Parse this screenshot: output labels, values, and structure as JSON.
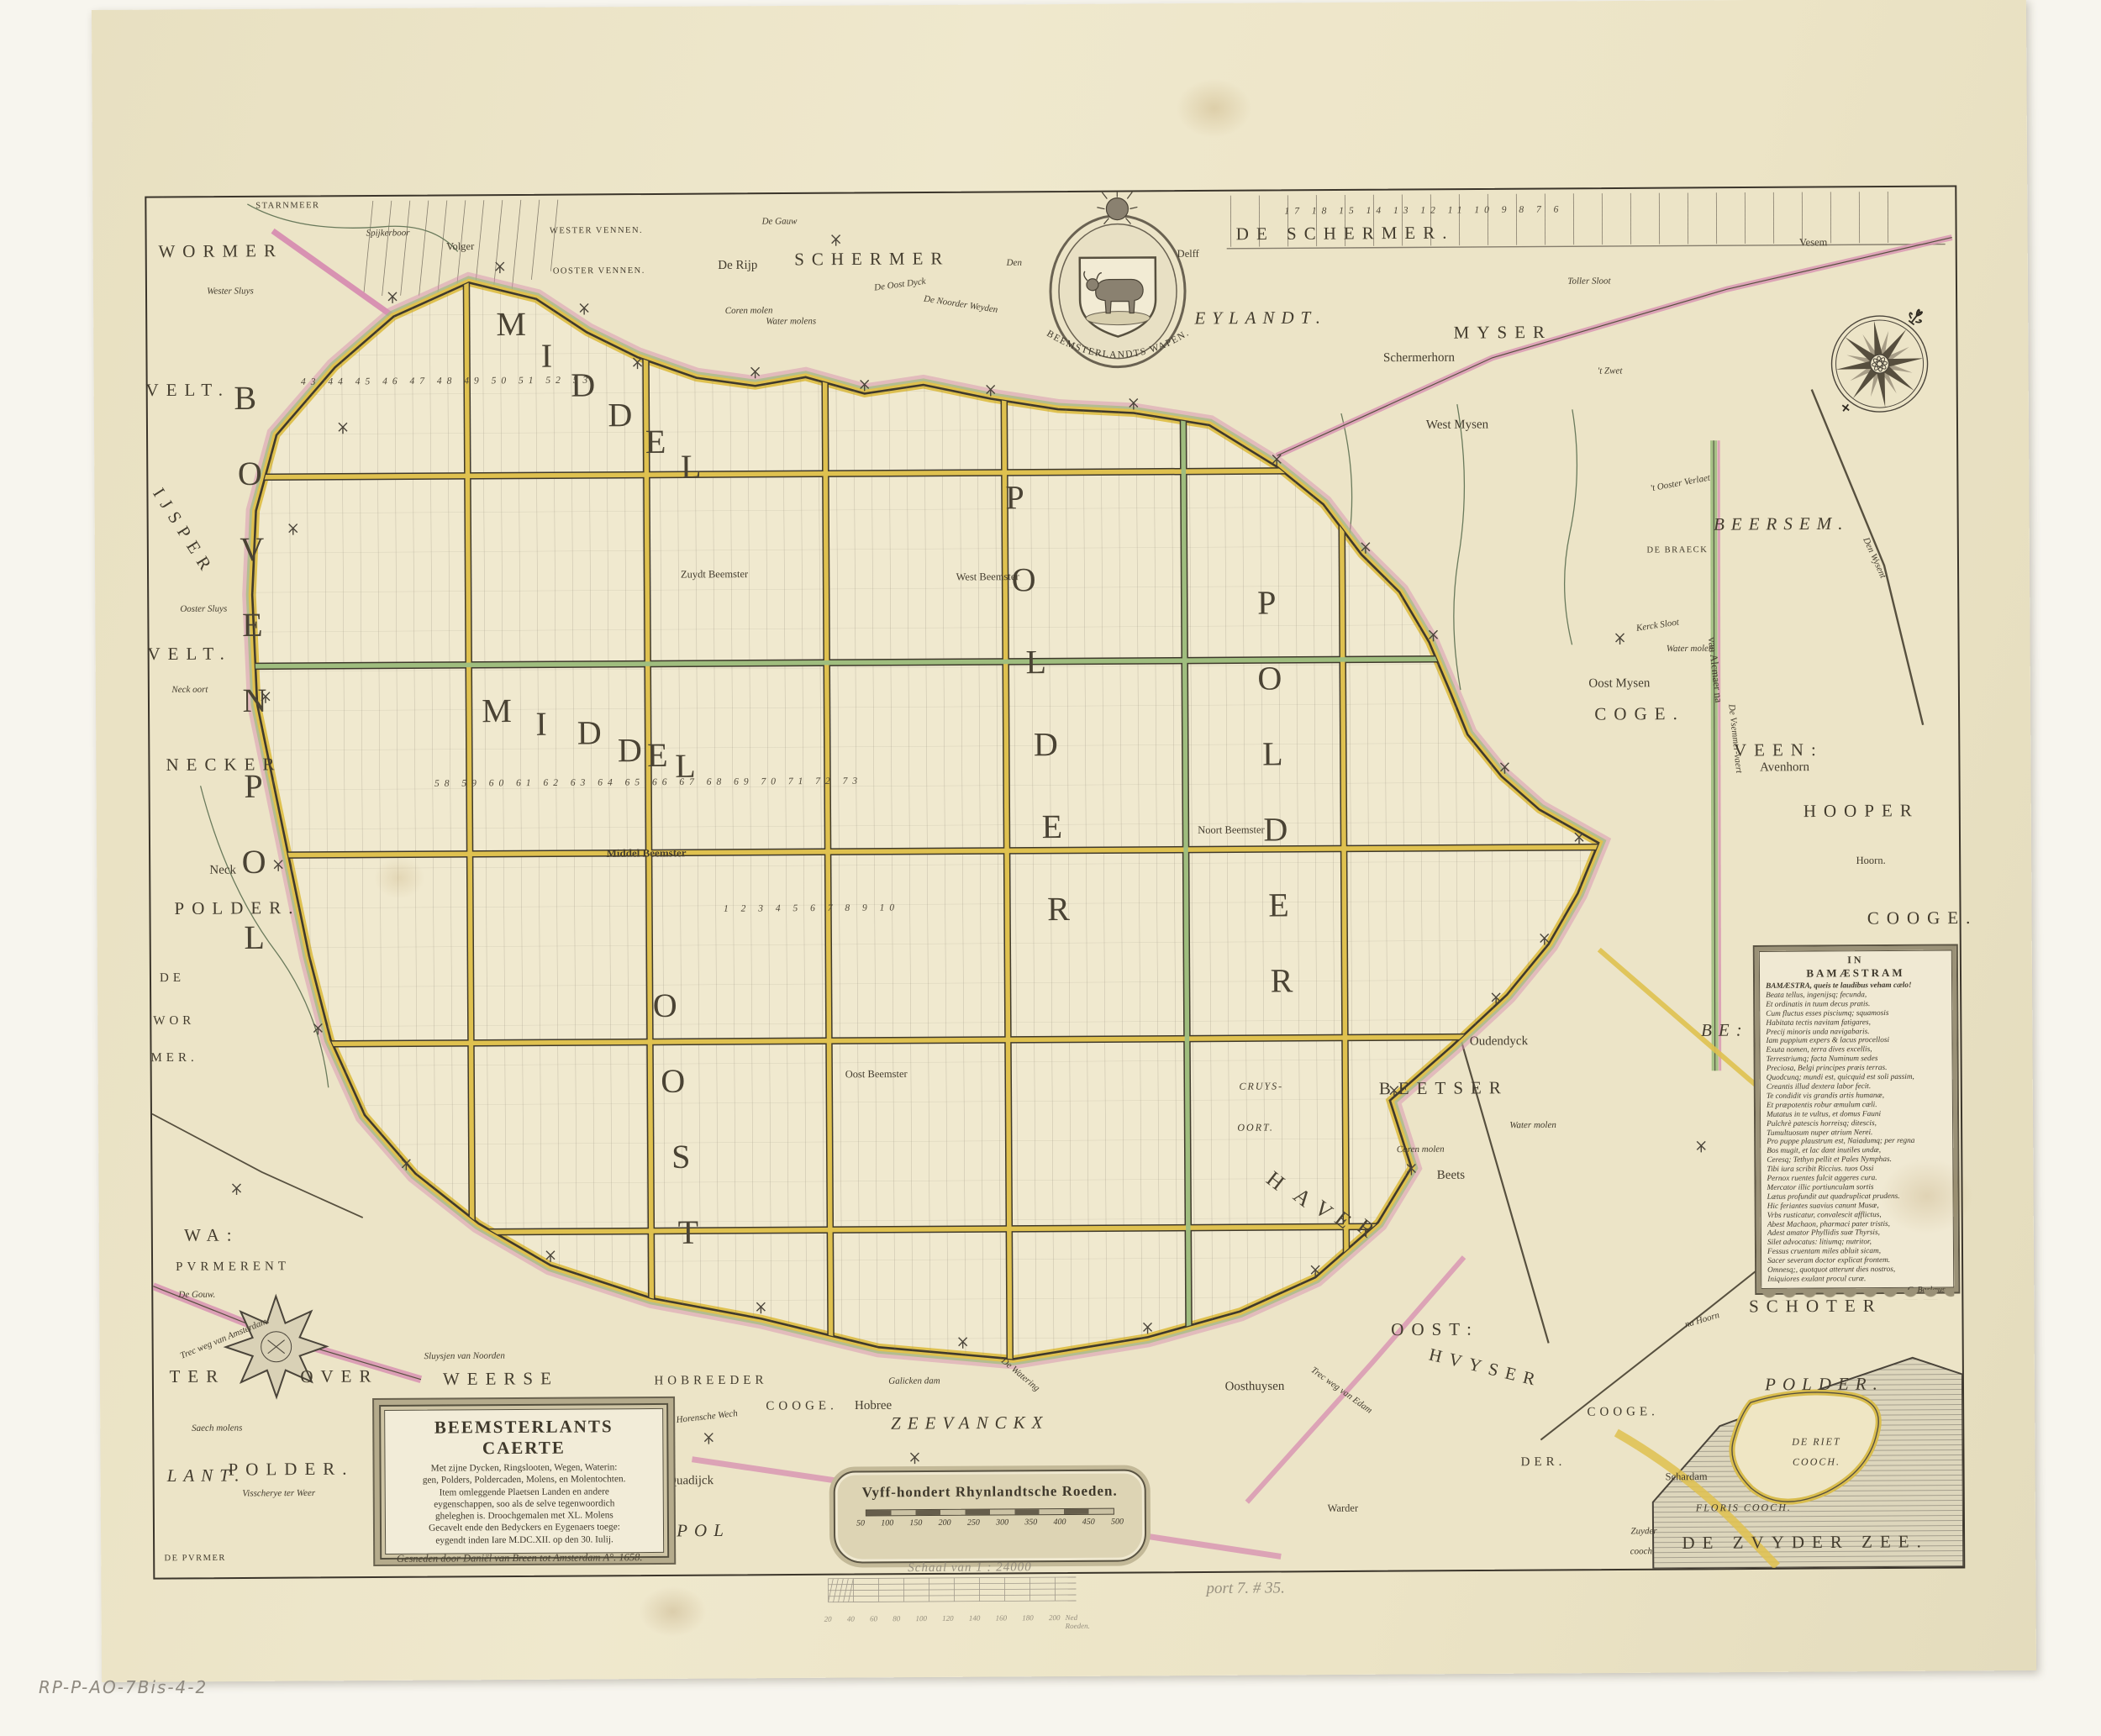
{
  "title_cartouche": {
    "title": "BEEMSTERLANTS CAERTE",
    "body_lines": [
      "Met zijne Dycken, Ringslooten, Wegen, Waterin:",
      "gen, Polders, Poldercaden, Molens, en Molentochten.",
      "Item omleggende Plaetsen Landen en andere",
      "eygenschappen, soo als de selve tegenwoordich",
      "gheleghen is. Droochgemalen met XL. Molens",
      "Gecavelt ende den Bedyckers en Eygenaers toege:",
      "eygendt inden Iare M.DC.XII. op den 30. Iulij."
    ],
    "imprint": "Gesneden door Daniël van Breen tot Amsterdam A°. 1658."
  },
  "scale_cartouche": {
    "title": "Vyff-hondert Rhynlandtsche Roeden.",
    "ticks": [
      "50",
      "100",
      "150",
      "200",
      "250",
      "300",
      "350",
      "400",
      "450",
      "500"
    ]
  },
  "poem": {
    "header1": "IN",
    "header2": "BAMÆSTRAM",
    "lines": [
      "BAMÆSTRA, queis te laudibus veham cælo!",
      "Beata tellus, ingenijsq; fecunda,",
      "Et ordinatis in tuum decus pratis.",
      "Cum fluctus esses pisciumq; squamosis",
      "Habitata tectis navitam fatigares,",
      "Precij minoris unda navigabaris.",
      "Iam puppium expers & lacus procellosi",
      "Exuta nomen, terra dives excellis,",
      "Terrestriumq; facta Numinum sedes",
      "Preciosa, Belgi principes præis terras.",
      "Quodcunq; mundi est, quicquid est soli passim,",
      "Creantis illud dextera labor fecit.",
      "Te condidit vis grandis artis humanæ,",
      "Et præpotentis robur æmulum cæli.",
      "Mutatus in te vultus, et domus Fauni",
      "Pulchrè patescis horreisq; ditescis,",
      "Tumultuosum nuper atrium Nerei.",
      "Pro puppe plaustrum est, Naiadumq; per regna",
      "Bos mugit, et lac dant inutiles undæ,",
      "Ceresq; Tethyn pellit et Pales Nymphas.",
      "Tibi iura scribit Riccius. tuos Ossi",
      "Pernox ruentes fulcit aggeres cura.",
      "Mercator illic portiunculam sortis",
      "Lætus profundit aut quadruplicat prudens.",
      "Hic feriantes suavius canunt Musæ,",
      "Vrbs rusticatur, convalescit afflictus,",
      "Abest Machaon, pharmaci pater tristis,",
      "Adest amator Phyllidis suæ Thyrsis,",
      "Silet advocatus: litiumq; nutritor,",
      "Fessus cruentam miles abluit sicam,",
      "Sacer severam doctor explicat frontem.",
      "Omnesq;, quotquot atterunt dies nostros,",
      "Iniquiores exulant procul curæ."
    ],
    "signature": "C. Barlæus."
  },
  "arms": {
    "caption": "BEEMSTERLANDTS WAPEN."
  },
  "pencil": {
    "scale_note": "Schaal van 1 : 24000",
    "ticks": [
      "20",
      "40",
      "60",
      "80",
      "100",
      "120",
      "140",
      "160",
      "180",
      "200"
    ],
    "unit": "Ned Roeden.",
    "inventory_note": "port 7. # 35.",
    "collection_mark": "RP-P-AO-7Bis-4-2"
  },
  "colors": {
    "paper": "#ece4c7",
    "road_yellow": "#dfc14f",
    "dike_pink": "#d892b2",
    "canal_green": "#9fbd7e",
    "ink": "#3f392c",
    "pencil": "#97907f"
  },
  "map_labels": [
    [
      "B",
      116,
      239,
      "g"
    ],
    [
      "O",
      121,
      329,
      "g"
    ],
    [
      "V",
      123,
      419,
      "g"
    ],
    [
      "E",
      123,
      509,
      "g"
    ],
    [
      "N",
      125,
      599,
      "g"
    ],
    [
      "P",
      123,
      701,
      "g"
    ],
    [
      "O",
      123,
      791,
      "g"
    ],
    [
      "L",
      123,
      881,
      "g"
    ],
    [
      "M",
      433,
      153,
      "g"
    ],
    [
      "I",
      475,
      191,
      "g"
    ],
    [
      "D",
      518,
      226,
      "g"
    ],
    [
      "D",
      562,
      262,
      "g"
    ],
    [
      "E",
      604,
      294,
      "g"
    ],
    [
      "L",
      646,
      324,
      "g"
    ],
    [
      "M",
      413,
      613,
      "g"
    ],
    [
      "I",
      466,
      629,
      "g"
    ],
    [
      "D",
      523,
      640,
      "g"
    ],
    [
      "D",
      571,
      661,
      "g"
    ],
    [
      "E",
      604,
      667,
      "g"
    ],
    [
      "L",
      637,
      680,
      "g"
    ],
    [
      "P",
      1031,
      363,
      "g"
    ],
    [
      "O",
      1041,
      461,
      "g"
    ],
    [
      "L",
      1055,
      559,
      "g"
    ],
    [
      "D",
      1066,
      657,
      "g"
    ],
    [
      "E",
      1073,
      755,
      "g"
    ],
    [
      "R",
      1080,
      853,
      "g"
    ],
    [
      "P",
      1330,
      490,
      "g"
    ],
    [
      "O",
      1333,
      580,
      "g"
    ],
    [
      "L",
      1336,
      670,
      "g"
    ],
    [
      "D",
      1339,
      760,
      "g"
    ],
    [
      "E",
      1342,
      850,
      "g"
    ],
    [
      "R",
      1345,
      940,
      "g"
    ],
    [
      "O",
      611,
      965,
      "g"
    ],
    [
      "O",
      620,
      1055,
      "g"
    ],
    [
      "S",
      629,
      1145,
      "g"
    ],
    [
      "T",
      637,
      1235,
      "g"
    ],
    [
      "H",
      1336,
      1178,
      "g2",
      38
    ],
    [
      "A",
      1368,
      1198,
      "g2",
      38
    ],
    [
      "V",
      1393,
      1213,
      "g2",
      38
    ],
    [
      "E",
      1416,
      1225,
      "g2",
      38
    ],
    [
      "R",
      1443,
      1235,
      "g2",
      38
    ],
    [
      "WORMER",
      88,
      64,
      "b"
    ],
    [
      "SCHERMER",
      863,
      78,
      "b"
    ],
    [
      "DE SCHERMER.",
      1426,
      51,
      "b"
    ],
    [
      "EYLANDT.",
      1325,
      151,
      "bi"
    ],
    [
      "MYSER",
      1613,
      170,
      "b"
    ],
    [
      "BEERSEM.",
      1943,
      400,
      "bi"
    ],
    [
      "COGE.",
      1773,
      625,
      "b"
    ],
    [
      "VEEN:",
      1938,
      669,
      "b"
    ],
    [
      "HOOPER",
      2036,
      742,
      "b"
    ],
    [
      "COOGE.",
      2108,
      870,
      "b"
    ],
    [
      "BEETSER",
      1537,
      1069,
      "b"
    ],
    [
      "BE:",
      1872,
      1002,
      "bi"
    ],
    [
      "SCHOTER",
      1978,
      1331,
      "b"
    ],
    [
      "POLDER.",
      1988,
      1424,
      "bi"
    ],
    [
      "DE ZVYDER ZEE.",
      1964,
      1612,
      "b"
    ],
    [
      "ZEEVANCKX",
      971,
      1464,
      "bi"
    ],
    [
      "OVER",
      221,
      1404,
      "b"
    ],
    [
      "WEERSE",
      413,
      1408,
      "b"
    ],
    [
      "OOST:",
      1525,
      1356,
      "b"
    ],
    [
      "HVYSER",
      1585,
      1402,
      "b",
      14
    ],
    [
      "COOGE.",
      1748,
      1456,
      "ms"
    ],
    [
      "DER.",
      1653,
      1515,
      "ms"
    ],
    [
      "HOBREEDER",
      663,
      1412,
      "ms"
    ],
    [
      "COOGE.",
      771,
      1443,
      "ms"
    ],
    [
      "POL",
      653,
      1590,
      "bi"
    ],
    [
      "WA:",
      70,
      1235,
      "b"
    ],
    [
      "TER",
      52,
      1403,
      "b"
    ],
    [
      "LANT.",
      62,
      1521,
      "bi"
    ],
    [
      "POLDER.",
      163,
      1514,
      "b"
    ],
    [
      "VELT.",
      48,
      229,
      "b"
    ],
    [
      "VELT.",
      48,
      543,
      "b"
    ],
    [
      "NECKER",
      88,
      675,
      "b"
    ],
    [
      "POLDER.",
      103,
      846,
      "b"
    ],
    [
      "IJSPER",
      42,
      398,
      "b",
      58
    ],
    [
      "DE",
      25,
      929,
      "ms"
    ],
    [
      "WOR",
      27,
      980,
      "ms"
    ],
    [
      "MER.",
      27,
      1024,
      "ms"
    ],
    [
      "STARNMEER",
      168,
      11,
      "tc"
    ],
    [
      "Spijkerboor",
      287,
      44,
      "t"
    ],
    [
      "Volger",
      373,
      60,
      "s"
    ],
    [
      "De Rijp",
      703,
      85,
      "m"
    ],
    [
      "De Gauw",
      753,
      33,
      "t"
    ],
    [
      "WESTER VENNEN.",
      535,
      43,
      "tc"
    ],
    [
      "OOSTER VENNEN.",
      538,
      91,
      "tc"
    ],
    [
      "De Oost Dyck",
      896,
      109,
      "t",
      -7
    ],
    [
      "De Noorder Weyden",
      968,
      133,
      "t",
      9
    ],
    [
      "Coren molen",
      716,
      139,
      "t"
    ],
    [
      "Water molens",
      766,
      152,
      "t"
    ],
    [
      "Den",
      1032,
      84,
      "t"
    ],
    [
      "Delff",
      1239,
      74,
      "s"
    ],
    [
      "Schermerhorn",
      1513,
      200,
      "m"
    ],
    [
      "West Mysen",
      1558,
      280,
      "m"
    ],
    [
      "Toller Sloot",
      1716,
      110,
      "t"
    ],
    [
      "'t Zwet",
      1740,
      217,
      "t"
    ],
    [
      "Vesem",
      1983,
      65,
      "s"
    ],
    [
      "DE BRAECK",
      1819,
      431,
      "tc"
    ],
    [
      "'t Ooster Verlaet",
      1823,
      351,
      "t",
      -10
    ],
    [
      "Kerck Sloot",
      1795,
      520,
      "t",
      -8
    ],
    [
      "Water molen",
      1833,
      548,
      "t"
    ],
    [
      "van Alcmaer na",
      1863,
      573,
      "s",
      84
    ],
    [
      "De Vsemmer-vaert",
      1886,
      655,
      "t",
      84
    ],
    [
      "Den Wysent",
      2053,
      441,
      "t",
      66
    ],
    [
      "Oost Mysen",
      1749,
      589,
      "m"
    ],
    [
      "Avenhorn",
      1945,
      690,
      "m"
    ],
    [
      "Hoorn.",
      2047,
      801,
      "s"
    ],
    [
      "Oudendyck",
      1603,
      1014,
      "m"
    ],
    [
      "Beets",
      1545,
      1173,
      "m"
    ],
    [
      "Coren molen",
      1509,
      1142,
      "t"
    ],
    [
      "Water molen",
      1643,
      1114,
      "t"
    ],
    [
      "CRUYS-",
      1320,
      1065,
      "sc"
    ],
    [
      "OORT.",
      1313,
      1114,
      "sc"
    ],
    [
      "na Hoorn",
      1843,
      1347,
      "t",
      -16
    ],
    [
      "DE RIET",
      1978,
      1492,
      "sc"
    ],
    [
      "COOCH.",
      1978,
      1516,
      "sc"
    ],
    [
      "FLORIS COOCH.",
      1891,
      1570,
      "sc"
    ],
    [
      "Schardam",
      1823,
      1533,
      "s"
    ],
    [
      "Zuyder",
      1772,
      1598,
      "t"
    ],
    [
      "cooch.",
      1770,
      1622,
      "t"
    ],
    [
      "De Watering",
      1031,
      1407,
      "t",
      40
    ],
    [
      "Oosthuysen",
      1310,
      1423,
      "m"
    ],
    [
      "Warder",
      1414,
      1568,
      "s"
    ],
    [
      "Trec weg van Edam",
      1413,
      1428,
      "t",
      36
    ],
    [
      "Galicken dam",
      905,
      1414,
      "t"
    ],
    [
      "Hobree",
      856,
      1443,
      "m"
    ],
    [
      "Horensche Wech",
      658,
      1455,
      "t",
      -6
    ],
    [
      "Quadijck",
      638,
      1531,
      "m"
    ],
    [
      "Sluysjen van Noorden",
      370,
      1381,
      "t"
    ],
    [
      "PVRMERENT",
      95,
      1273,
      "ms"
    ],
    [
      "De Gouw.",
      52,
      1306,
      "t"
    ],
    [
      "Trec weg van Amsterdam.",
      85,
      1358,
      "t",
      -22
    ],
    [
      "Saech molens",
      75,
      1465,
      "t"
    ],
    [
      "Visscherye ter Weer",
      148,
      1543,
      "t"
    ],
    [
      "DE PVRMER",
      48,
      1620,
      "tc"
    ],
    [
      "Neck oort",
      48,
      586,
      "t"
    ],
    [
      "Neck",
      86,
      801,
      "m"
    ],
    [
      "Ooster Sluys",
      65,
      490,
      "t"
    ],
    [
      "Wester Sluys",
      99,
      112,
      "t"
    ],
    [
      "Zuydt Beemster",
      673,
      452,
      "s"
    ],
    [
      "West Beemster",
      998,
      457,
      "s"
    ],
    [
      "Noort Beemster",
      1286,
      760,
      "s"
    ],
    [
      "Middel Beemster",
      590,
      783,
      "sb"
    ],
    [
      "Oost Beemster",
      862,
      1048,
      "s"
    ],
    [
      "43 44 45 46 47 48 49 50 51 52 53",
      356,
      221,
      "n"
    ],
    [
      "58 59 60 61 62 63 64 65 66 67 68 69 70 71 72 73",
      593,
      700,
      "n"
    ],
    [
      "1 2 3 4 5 6 7 8 9 10",
      786,
      851,
      "n"
    ],
    [
      "17 18 15 14 13 12 11 10 9 8 7 6",
      1520,
      25,
      "n"
    ]
  ]
}
